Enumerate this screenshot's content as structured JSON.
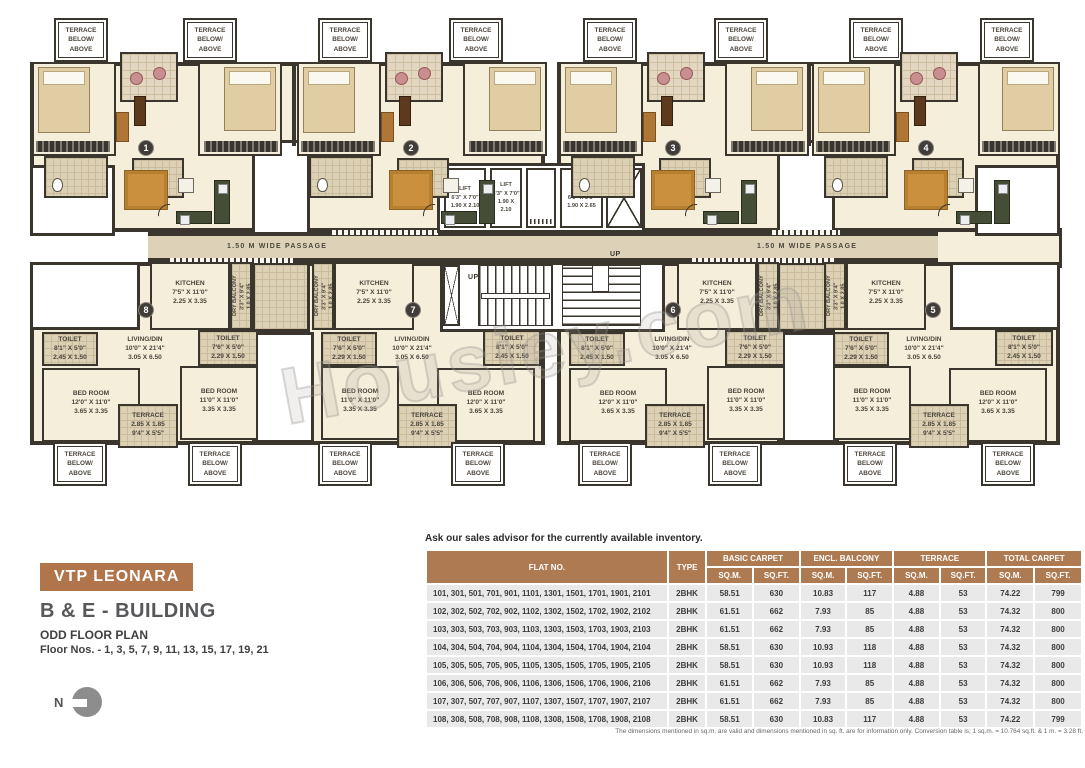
{
  "watermark": "Housiey.com",
  "colors": {
    "accent": "#ae7a51",
    "wall": "#3a362d",
    "room_cream": "#f5eedb",
    "passage_tan": "#ddd2b8",
    "row_gray": "#e9e9e9"
  },
  "plan": {
    "terrace_note": "TERRACE BELOW/ ABOVE",
    "passage": "1.50 M WIDE PASSAGE",
    "up": "UP",
    "units": {
      "u1": "1",
      "u2": "2",
      "u3": "3",
      "u4": "4",
      "u5": "5",
      "u6": "6",
      "u7": "7",
      "u8": "8"
    },
    "lift_small": {
      "label": "LIFT",
      "ft": "6'3\" X 7'0\"",
      "m": "1.90 X 2.10"
    },
    "lift_large": {
      "label": "LIFT",
      "ft": "6'3\" X 8'8\"",
      "m": "1.90 X 2.65"
    },
    "rooms": {
      "kitchen": {
        "name": "KITCHEN",
        "ft": "7'5\" X 11'0\"",
        "m": "2.25 X 3.35"
      },
      "dry_balcony": {
        "name": "DRY BALCONY",
        "ft": "3'3\" X 9'4\"",
        "m": "1.0 X 2.85"
      },
      "toilet_a": {
        "name": "TOILET",
        "ft": "8'1\" X 5'0\"",
        "m": "2.45 X 1.50"
      },
      "toilet_b": {
        "name": "TOILET",
        "ft": "7'6\" X 5'0\"",
        "m": "2.29 X 1.50"
      },
      "living": {
        "name": "LIVING/DIN",
        "ft": "10'0\" X 21'4\"",
        "m": "3.05 X 6.50"
      },
      "bed_a": {
        "name": "BED ROOM",
        "ft": "12'0\" X 11'0\"",
        "m": "3.65 X 3.35"
      },
      "bed_b": {
        "name": "BED ROOM",
        "ft": "11'0\" X 11'0\"",
        "m": "3.35 X 3.35"
      },
      "terrace": {
        "name": "TERRACE",
        "m": "2.85 X 1.85",
        "ft": "9'4\" X 5'5\""
      }
    }
  },
  "info": {
    "project": "VTP LEONARA",
    "building": "B & E - BUILDING",
    "plan_type": "ODD FLOOR PLAN",
    "floors": "Floor Nos. - 1, 3, 5, 7, 9, 11, 13, 15, 17, 19, 21",
    "north": "N"
  },
  "inventory": {
    "note": "Ask our sales advisor for the currently available inventory.",
    "headers": {
      "flat": "FLAT NO.",
      "type": "TYPE",
      "basic": "BASIC CARPET",
      "encl": "ENCL. BALCONY",
      "terrace": "TERRACE",
      "total": "TOTAL CARPET",
      "sqm": "SQ.M.",
      "sqft": "SQ.FT."
    },
    "rows": [
      {
        "flats": "101, 301, 501, 701, 901, 1101, 1301, 1501, 1701, 1901, 2101",
        "type": "2BHK",
        "basic_sqm": "58.51",
        "basic_sqft": "630",
        "encl_sqm": "10.83",
        "encl_sqft": "117",
        "ter_sqm": "4.88",
        "ter_sqft": "53",
        "total_sqm": "74.22",
        "total_sqft": "799"
      },
      {
        "flats": "102, 302, 502, 702, 902, 1102, 1302, 1502, 1702, 1902, 2102",
        "type": "2BHK",
        "basic_sqm": "61.51",
        "basic_sqft": "662",
        "encl_sqm": "7.93",
        "encl_sqft": "85",
        "ter_sqm": "4.88",
        "ter_sqft": "53",
        "total_sqm": "74.32",
        "total_sqft": "800"
      },
      {
        "flats": "103, 303, 503, 703, 903, 1103, 1303, 1503, 1703, 1903, 2103",
        "type": "2BHK",
        "basic_sqm": "61.51",
        "basic_sqft": "662",
        "encl_sqm": "7.93",
        "encl_sqft": "85",
        "ter_sqm": "4.88",
        "ter_sqft": "53",
        "total_sqm": "74.32",
        "total_sqft": "800"
      },
      {
        "flats": "104, 304, 504, 704, 904, 1104, 1304, 1504, 1704, 1904, 2104",
        "type": "2BHK",
        "basic_sqm": "58.51",
        "basic_sqft": "630",
        "encl_sqm": "10.93",
        "encl_sqft": "118",
        "ter_sqm": "4.88",
        "ter_sqft": "53",
        "total_sqm": "74.32",
        "total_sqft": "800"
      },
      {
        "flats": "105, 305, 505, 705, 905, 1105, 1305, 1505, 1705, 1905, 2105",
        "type": "2BHK",
        "basic_sqm": "58.51",
        "basic_sqft": "630",
        "encl_sqm": "10.93",
        "encl_sqft": "118",
        "ter_sqm": "4.88",
        "ter_sqft": "53",
        "total_sqm": "74.32",
        "total_sqft": "800"
      },
      {
        "flats": "106, 306, 506, 706, 906, 1106, 1306, 1506, 1706, 1906, 2106",
        "type": "2BHK",
        "basic_sqm": "61.51",
        "basic_sqft": "662",
        "encl_sqm": "7.93",
        "encl_sqft": "85",
        "ter_sqm": "4.88",
        "ter_sqft": "53",
        "total_sqm": "74.32",
        "total_sqft": "800"
      },
      {
        "flats": "107, 307, 507, 707, 907, 1107, 1307, 1507, 1707, 1907, 2107",
        "type": "2BHK",
        "basic_sqm": "61.51",
        "basic_sqft": "662",
        "encl_sqm": "7.93",
        "encl_sqft": "85",
        "ter_sqm": "4.88",
        "ter_sqft": "53",
        "total_sqm": "74.32",
        "total_sqft": "800"
      },
      {
        "flats": "108, 308, 508, 708, 908, 1108, 1308, 1508, 1708, 1908, 2108",
        "type": "2BHK",
        "basic_sqm": "58.51",
        "basic_sqft": "630",
        "encl_sqm": "10.83",
        "encl_sqft": "117",
        "ter_sqm": "4.88",
        "ter_sqft": "53",
        "total_sqm": "74.22",
        "total_sqft": "799"
      }
    ],
    "footnote": "The dimensions mentioned in sq.m. are valid and dimensions mentioned in sq. ft. are for information only. Conversion table is; 1 sq.m. = 10.764 sq.ft. & 1 m. = 3.28 ft."
  }
}
